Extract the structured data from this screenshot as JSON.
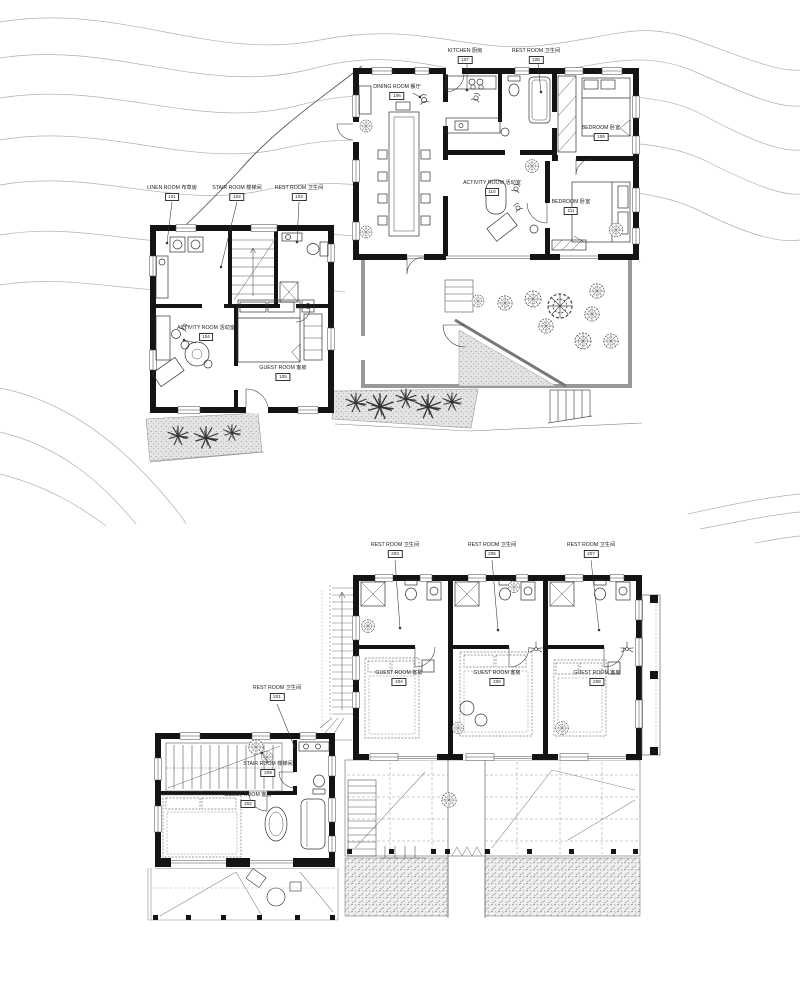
{
  "sheet": {
    "background": "#ffffff"
  },
  "colors": {
    "ink": "#141414",
    "furniture": "#333333",
    "site": "#888888",
    "contour": "#b0b0b0",
    "hatch_bg": "#e4e4e4",
    "hatch_dot": "#8a8a8a"
  },
  "floor1": {
    "labels": {
      "kitchen": {
        "text": "KITCHEN 厨房",
        "num": "107"
      },
      "rest_top": {
        "text": "REST ROOM 卫生间",
        "num": "108"
      },
      "dining": {
        "text": "DINING ROOM 餐厅",
        "num": "106"
      },
      "bedroom1": {
        "text": "BEDROOM 卧室",
        "num": "109"
      },
      "activity_main": {
        "text": "ACTIVITY ROOM 活动室",
        "num": "110"
      },
      "bedroom2": {
        "text": "BEDROOM 卧室",
        "num": "111"
      },
      "linen": {
        "text": "LINEN ROOM 布草房",
        "num": "101"
      },
      "stair": {
        "text": "STAIR ROOM 楼梯间",
        "num": "102"
      },
      "rest_left": {
        "text": "REST ROOM 卫生间",
        "num": "103"
      },
      "activity_left": {
        "text": "ACTIVITY ROOM 活动室",
        "num": "104"
      },
      "guest": {
        "text": "GUEST ROOM 客房",
        "num": "105"
      }
    }
  },
  "floor2": {
    "labels": {
      "rest1": {
        "text": "REST ROOM 卫生间",
        "num": "203"
      },
      "rest2": {
        "text": "REST ROOM 卫生间",
        "num": "205"
      },
      "rest3": {
        "text": "REST ROOM 卫生间",
        "num": "207"
      },
      "guest1": {
        "text": "GUEST ROOM 客房",
        "num": "204"
      },
      "guest2": {
        "text": "GUEST ROOM 客房",
        "num": "206"
      },
      "guest3": {
        "text": "GUEST ROOM 客房",
        "num": "208"
      },
      "rest_left": {
        "text": "REST ROOM 卫生间",
        "num": "201"
      },
      "stair_left": {
        "text": "STAIR ROOM 楼梯间",
        "num": "209"
      },
      "guest_left": {
        "text": "GUEST ROOM 客房",
        "num": "202"
      }
    }
  }
}
